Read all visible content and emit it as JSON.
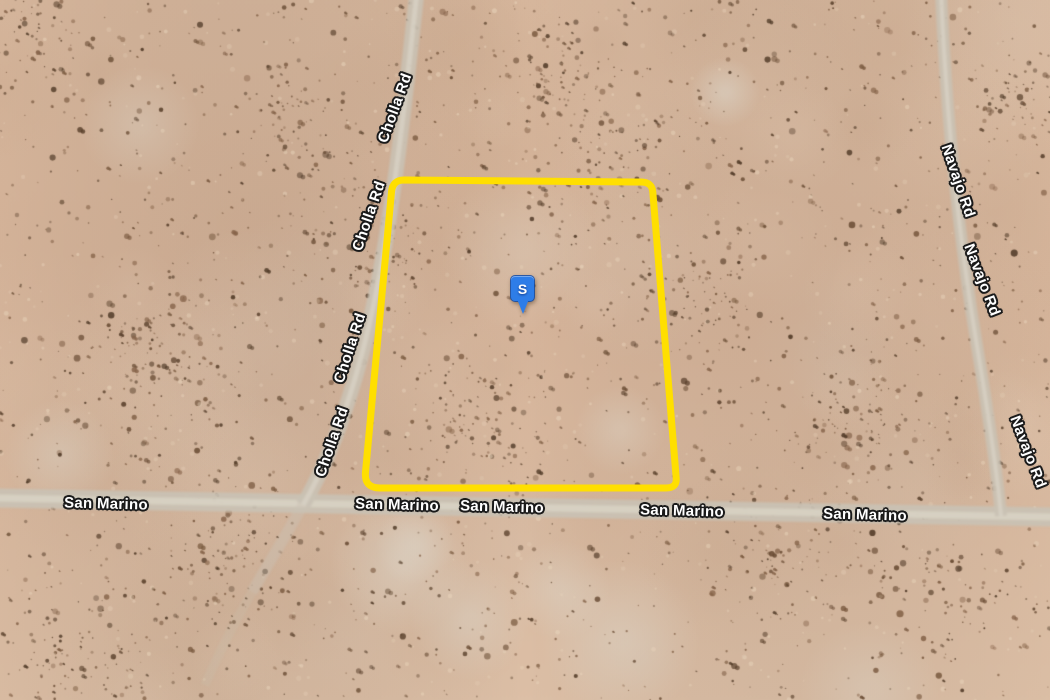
{
  "map": {
    "marker": {
      "label": "S",
      "color": "#2E7DE8"
    },
    "parcel": {
      "outline_color": "#FFDF00"
    },
    "roads": {
      "cholla": {
        "label": "Cholla Rd",
        "label_positions": [
          {
            "x": 395,
            "y": 108,
            "rotate": -70
          },
          {
            "x": 369,
            "y": 216,
            "rotate": -71
          },
          {
            "x": 350,
            "y": 348,
            "rotate": -72
          },
          {
            "x": 332,
            "y": 442,
            "rotate": -71
          }
        ]
      },
      "san_marino": {
        "label": "San Marino",
        "label_positions": [
          {
            "x": 106,
            "y": 504,
            "rotate": 1.5
          },
          {
            "x": 397,
            "y": 505,
            "rotate": 1.5
          },
          {
            "x": 502,
            "y": 507,
            "rotate": 1.5
          },
          {
            "x": 682,
            "y": 511,
            "rotate": 1.5
          },
          {
            "x": 865,
            "y": 515,
            "rotate": 1.5
          }
        ]
      },
      "navajo": {
        "label": "Navajo Rd",
        "label_positions": [
          {
            "x": 958,
            "y": 181,
            "rotate": 71
          },
          {
            "x": 982,
            "y": 280,
            "rotate": 69
          },
          {
            "x": 1028,
            "y": 452,
            "rotate": 69
          }
        ]
      }
    },
    "colors": {
      "sand": "#D7B79C",
      "road": "#C9C1B4",
      "road_center": "#DAD3C6",
      "vegetation_speckle": "#6B4E36",
      "label_text": "#FFFFFF",
      "label_outline": "#1A1A1A"
    }
  }
}
